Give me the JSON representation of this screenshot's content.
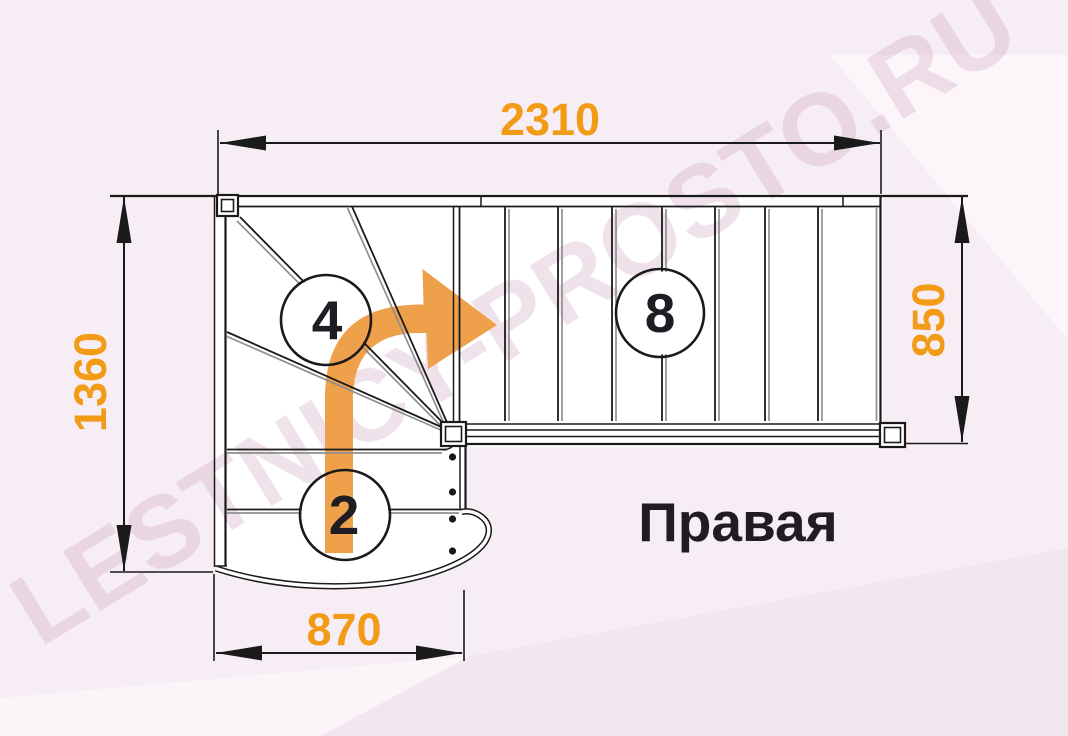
{
  "diagram": {
    "title": "Правая",
    "watermark": "LESTNICY-PROSTO.RU",
    "dimensions": {
      "top": "2310",
      "left": "1360",
      "right": "850",
      "bottom": "870"
    },
    "step_counts": {
      "winder_flight": "4",
      "upper_flight": "8",
      "lower_flight": "2"
    }
  },
  "colors": {
    "bg-base": "#f7edf4",
    "bg-light": "#fbf4f9",
    "bg-deep": "#f3e7ef",
    "line-dark": "#1a1a1a",
    "line-gray": "#8f8f8f",
    "accent-orange": "#F29B16",
    "arrow-orange": "#EFA04A",
    "text-dark": "#201c24",
    "wm-pink": "#CDA0BC"
  }
}
